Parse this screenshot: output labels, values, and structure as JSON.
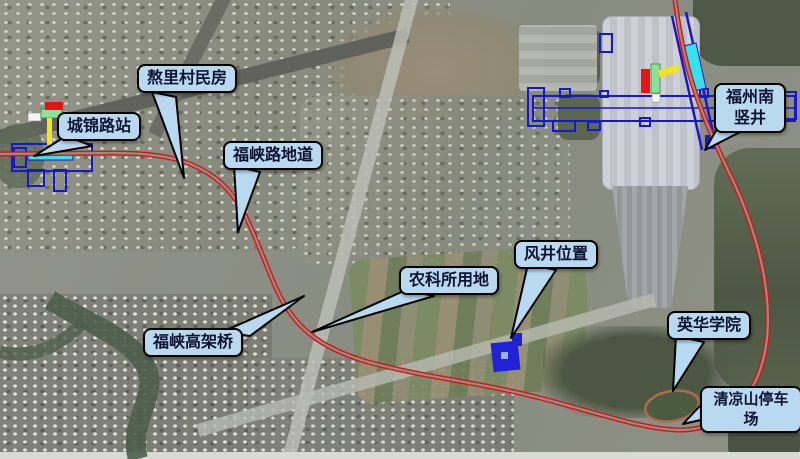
{
  "figure": {
    "type": "annotated-satellite-map",
    "callouts": [
      {
        "id": "chengjin-road-station",
        "label": "城锦路站"
      },
      {
        "id": "aoli-village-houses",
        "label": "熬里村民房"
      },
      {
        "id": "fuxia-road-underpass",
        "label": "福峡路地道"
      },
      {
        "id": "fuxia-viaduct",
        "label": "福峡高架桥"
      },
      {
        "id": "agri-science-institute-land",
        "label": "农科所用地"
      },
      {
        "id": "vent-shaft-location",
        "label": "风井位置"
      },
      {
        "id": "yinghua-college",
        "label": "英华学院"
      },
      {
        "id": "fuzhou-south-shaft",
        "label": "福州南竖井"
      },
      {
        "id": "qingliangshan-parking-lot",
        "label": "清凉山停车场"
      }
    ],
    "colors": {
      "alignment_red": "#dd1111",
      "structure_blue": "#1717cc",
      "callout_fill": "#b9d9f0",
      "callout_border": "#000000",
      "cyan_marker": "#35e2ee",
      "yellow_marker": "#f3e422",
      "green_marker": "#90e09c",
      "red_marker": "#e51515",
      "white_marker": "#f5f5f5"
    },
    "map_feature_names": [
      "metro-alignment-double-red-line",
      "chengjin-road-station-structure-plan",
      "fuzhou-south-station-structure-plan",
      "vent-shaft-footprint",
      "fuzhou-south-railway-station-building",
      "stadium-oval",
      "river-channel"
    ]
  }
}
